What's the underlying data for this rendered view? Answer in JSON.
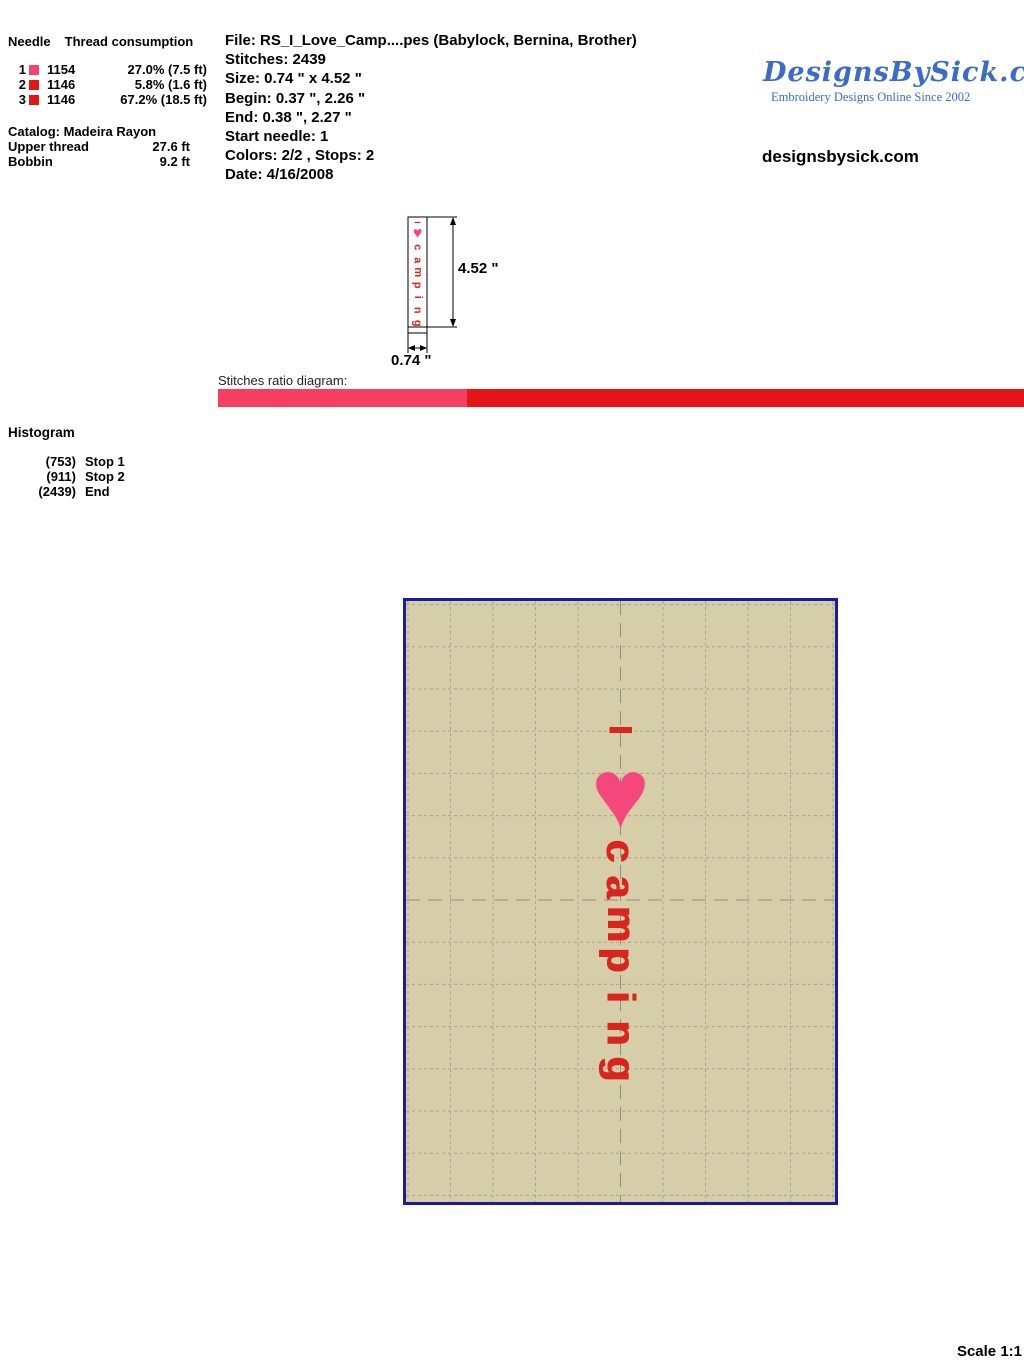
{
  "colors": {
    "thread_pink": "#f2446f",
    "thread_red": "#e41519",
    "bar_pink": "#f43f63",
    "bar_red": "#e41519",
    "design_red": "#d8251d",
    "design_pink": "#f4477c",
    "hoop_bg": "#d6cda9",
    "hoop_border": "#1c1c99",
    "logo_blue": "#3a6cc8"
  },
  "thread_panel": {
    "header_needle": "Needle",
    "header_consumption": "Thread consumption",
    "rows": [
      {
        "needle": "1",
        "color": "#f2446f",
        "code": "1154",
        "consumption": "27.0% (7.5 ft)"
      },
      {
        "needle": "2",
        "color": "#e41519",
        "code": "1146",
        "consumption": "5.8% (1.6 ft)"
      },
      {
        "needle": "3",
        "color": "#e41519",
        "code": "1146",
        "consumption": "67.2% (18.5 ft)"
      }
    ],
    "catalog": "Catalog: Madeira Rayon",
    "upper_thread_label": "Upper thread",
    "upper_thread_value": "27.6 ft",
    "bobbin_label": "Bobbin",
    "bobbin_value": "9.2 ft"
  },
  "file_info": {
    "lines": [
      "File: RS_I_Love_Camp....pes  (Babylock, Bernina, Brother)",
      "Stitches: 2439",
      "Size: 0.74 \" x 4.52 \"",
      "Begin: 0.37 \", 2.26 \"",
      "End: 0.38 \", 2.27 \"",
      "Start needle: 1",
      "Colors: 2/2 , Stops: 2",
      "Date: 4/16/2008"
    ]
  },
  "logo": {
    "title": "DesignsBySick.com",
    "tagline": "Embroidery Designs Online Since 2002",
    "site": "designsbysick.com"
  },
  "dimensions": {
    "height_label": "4.52 \"",
    "width_label": "0.74 \""
  },
  "ratio_diagram": {
    "label": "Stitches ratio diagram:",
    "segments": [
      {
        "color": "#f43f63",
        "percent": 30.9
      },
      {
        "color": "#e41519",
        "percent": 69.1
      }
    ]
  },
  "histogram": {
    "title": "Histogram",
    "entries": [
      {
        "count": "(753)",
        "label": "Stop 1"
      },
      {
        "count": "(911)",
        "label": "Stop 2"
      },
      {
        "count": "(2439)",
        "label": "End"
      }
    ]
  },
  "design": {
    "letter_i": "I",
    "heart": "♥",
    "word": "camping",
    "letter_color": "#d8251d",
    "heart_color": "#f4477c"
  },
  "scale": {
    "label": "Scale 1:1"
  }
}
